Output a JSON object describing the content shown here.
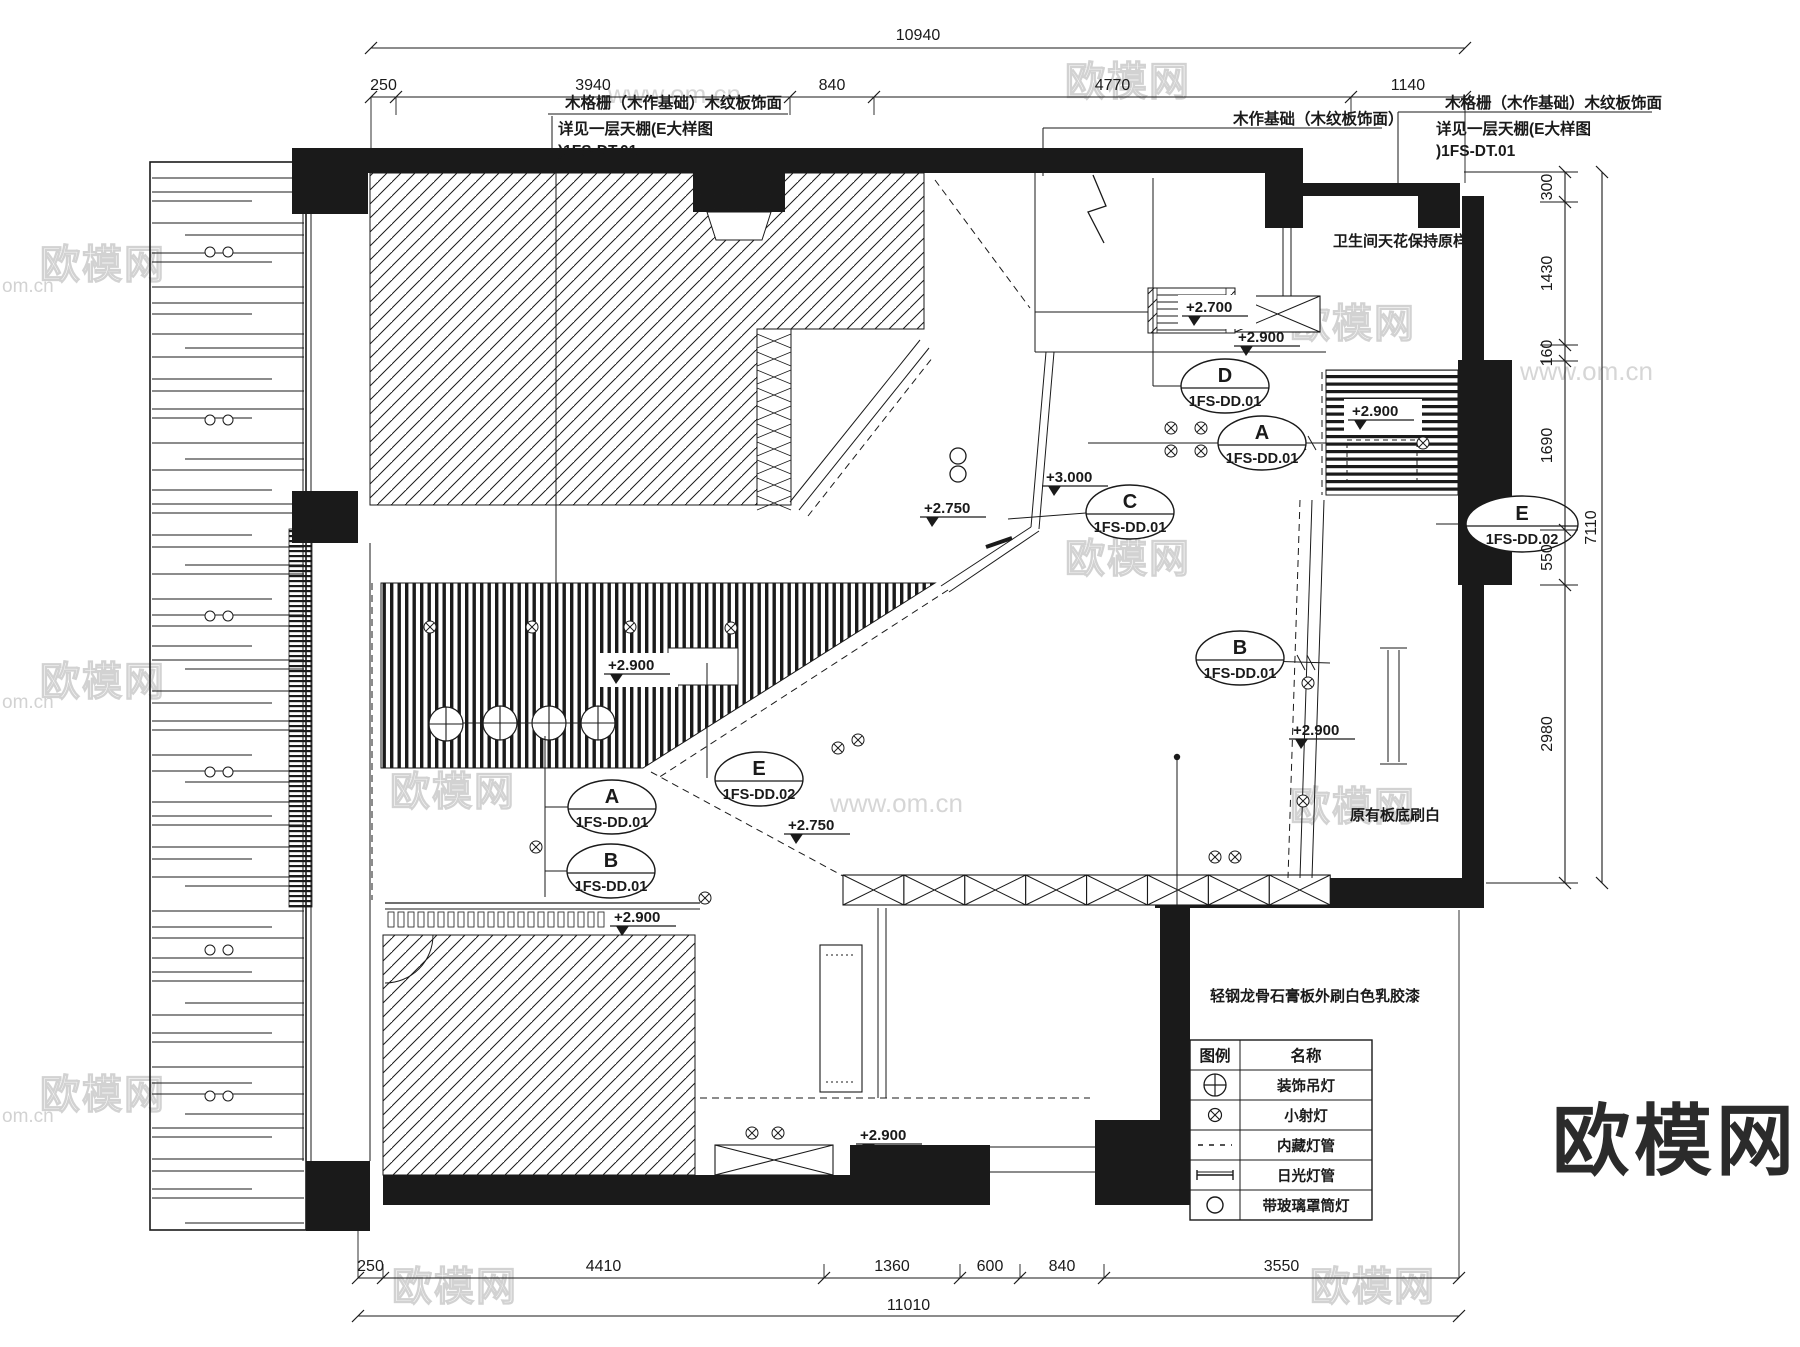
{
  "annotations": {
    "left": {
      "line1": "木格栅（木作基础）木纹板饰面",
      "line2": "详见一层天棚(E大样图",
      "line3": ")1FS-DT.01"
    },
    "middle": {
      "line1": "木作基础（木纹板饰面）"
    },
    "right": {
      "line1": "木格栅（木作基础）木纹板饰面",
      "line2": "详见一层天棚(E大样图",
      "line3": ")1FS-DT.01"
    },
    "bathroom": "卫生间天花保持原样",
    "slab": "原有板底刷白",
    "gypsum": "轻钢龙骨石膏板外刷白色乳胶漆"
  },
  "elevations": [
    "+2.700",
    "+2.900",
    "+2.900",
    "+3.000",
    "+2.750",
    "+2.750",
    "+2.900",
    "+2.900",
    "+2.900",
    "+2.900"
  ],
  "ovals": [
    {
      "letter": "D",
      "code": "1FS-DD.01"
    },
    {
      "letter": "A",
      "code": "1FS-DD.01"
    },
    {
      "letter": "C",
      "code": "1FS-DD.01"
    },
    {
      "letter": "E",
      "code": "1FS-DD.02"
    },
    {
      "letter": "E",
      "code": "1FS-DD.02"
    },
    {
      "letter": "A",
      "code": "1FS-DD.01"
    },
    {
      "letter": "B",
      "code": "1FS-DD.01"
    },
    {
      "letter": "B",
      "code": "1FS-DD.01"
    }
  ],
  "dimensions": {
    "top": {
      "total": "10940",
      "segments": [
        "250",
        "3940",
        "840",
        "4770",
        "1140"
      ]
    },
    "bottom": {
      "total": "11010",
      "segments": [
        "250",
        "4410",
        "1360",
        "600",
        "840",
        "3550"
      ]
    },
    "right": {
      "total": "7110",
      "segments": [
        "300",
        "1430",
        "160",
        "1690",
        "550",
        "2980"
      ]
    }
  },
  "legend": {
    "headers": [
      "图例",
      "名称"
    ],
    "rows": [
      {
        "symbol": "chandelier",
        "name": "装饰吊灯"
      },
      {
        "symbol": "spotlight",
        "name": "小射灯"
      },
      {
        "symbol": "concealed-tube",
        "name": "内藏灯管"
      },
      {
        "symbol": "fluorescent-tube",
        "name": "日光灯管"
      },
      {
        "symbol": "glass-downlight",
        "name": "带玻璃罩筒灯"
      }
    ]
  },
  "watermarks": {
    "brand": "欧模网",
    "site": "www.om.cn",
    "site_short": "om.cn"
  },
  "logo": "欧模网",
  "colors": {
    "line": "#1a1a1a",
    "watermark": "#cccccc",
    "logo": "#2b2b2b",
    "background": "#ffffff"
  }
}
